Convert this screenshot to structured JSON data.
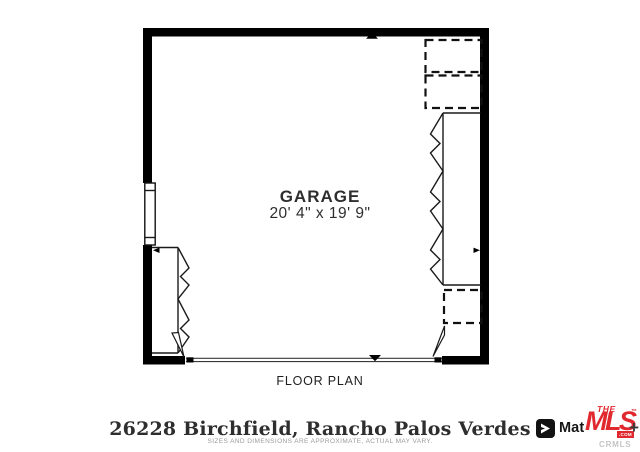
{
  "plan": {
    "room_label": "GARAGE",
    "room_dimensions": "20' 4\" x 19' 9\"",
    "caption": "FLOOR PLAN"
  },
  "footer": {
    "address": "26228 Birchfield, Rancho Palos Verdes",
    "disclaimer": "SIZES AND DIMENSIONS ARE APPROXIMATE, ACTUAL MAY VARY."
  },
  "branding": {
    "matterport": "Matterport",
    "mls_the": "THE",
    "mls_name": "MLS",
    "mls_com": ".com",
    "mls_plus": "+",
    "mls_tm": "™",
    "mls_sub": "CRMLS"
  },
  "colors": {
    "wall": "#000000",
    "mls_red": "#e0282e",
    "text_dark": "#2b2b2b",
    "disclaimer_gray": "#9b9b9b"
  }
}
